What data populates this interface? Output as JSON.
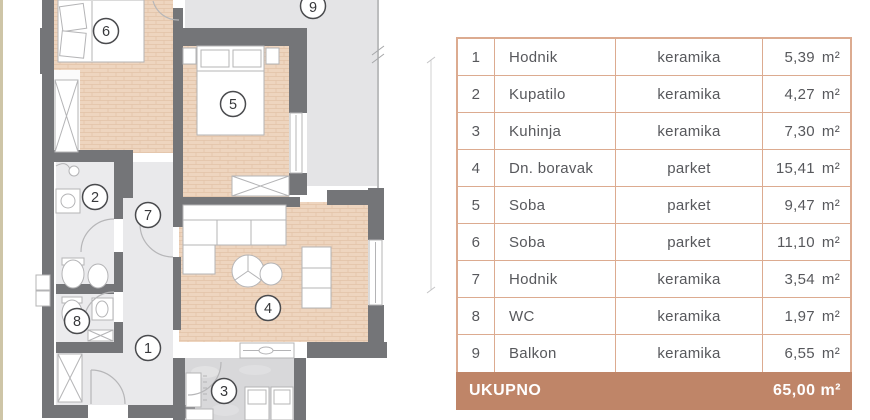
{
  "plan": {
    "labels": [
      "6",
      "9",
      "5",
      "2",
      "7",
      "8",
      "1",
      "4",
      "3"
    ]
  },
  "table": {
    "rows": [
      {
        "num": "1",
        "name": "Hodnik",
        "material": "keramika",
        "area": "5,39",
        "unit": "m²"
      },
      {
        "num": "2",
        "name": "Kupatilo",
        "material": "keramika",
        "area": "4,27",
        "unit": "m²"
      },
      {
        "num": "3",
        "name": "Kuhinja",
        "material": "keramika",
        "area": "7,30",
        "unit": "m²"
      },
      {
        "num": "4",
        "name": "Dn. boravak",
        "material": "parket",
        "area": "15,41",
        "unit": "m²"
      },
      {
        "num": "5",
        "name": "Soba",
        "material": "parket",
        "area": "9,47",
        "unit": "m²"
      },
      {
        "num": "6",
        "name": "Soba",
        "material": "parket",
        "area": "11,10",
        "unit": "m²"
      },
      {
        "num": "7",
        "name": "Hodnik",
        "material": "keramika",
        "area": "3,54",
        "unit": "m²"
      },
      {
        "num": "8",
        "name": "WC",
        "material": "keramika",
        "area": "1,97",
        "unit": "m²"
      },
      {
        "num": "9",
        "name": "Balkon",
        "material": "keramika",
        "area": "6,55",
        "unit": "m²"
      }
    ],
    "footer": {
      "label": "UKUPNO",
      "total": "65,00 m²"
    }
  },
  "colors": {
    "table_border": "#dcab90",
    "footer_bg": "#bf8568",
    "wall": "#747578",
    "parquet": "#eed5bf",
    "ceramic": "#ebebed",
    "balcony": "#e4e4e6",
    "kitchen_tile": "#d8d8da"
  }
}
